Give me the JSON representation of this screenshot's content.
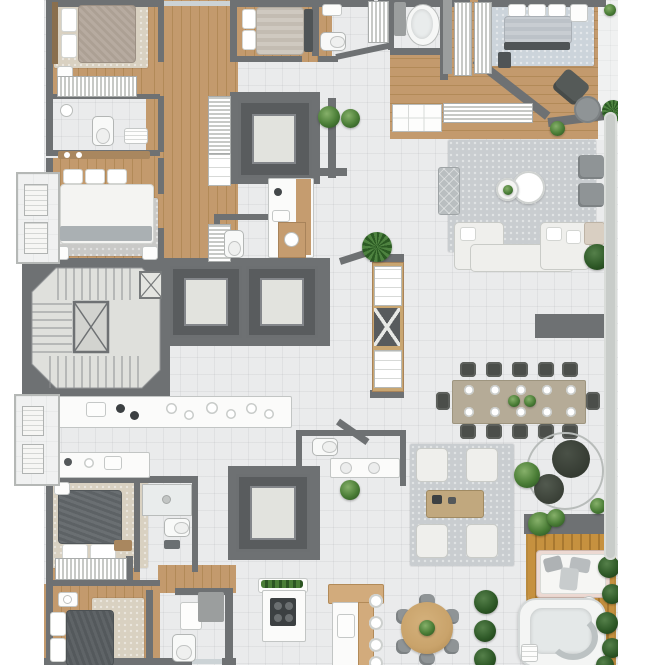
{
  "meta": {
    "title": "Residential apartment floor plan — top-down 3D render",
    "domain_note": "architectural floor plan, no on-screen text",
    "view": "top-down orthographic"
  },
  "palette": {
    "wall": "#6e7173",
    "wallLight": "#9a9da0",
    "tile": "#eaebec",
    "tileLight": "#f0f1f1",
    "wood": "#c39a6d",
    "woodDark": "#b28a58",
    "deck": "#c6913f",
    "deckDark": "#a87830",
    "shaft": "#595c5e",
    "shaftInner": "#e2e3de",
    "rugGray": "#c9cdd0",
    "rugBlue": "#ccd4db",
    "rugBeige": "#d9d1c1",
    "sofaWhite": "#efefec",
    "chairDark": "#4b4e4a",
    "chairGray": "#8f9496",
    "tableWood": "#b5ab97",
    "roundTableWood": "#c9a36b",
    "plantGreen": "#4a7d36",
    "railing": "#c8ccc9",
    "glass": "#ccd3d6",
    "hotTubWhite": "#f4f5f4"
  },
  "rooms": [
    {
      "id": "bedroom-1",
      "area": "top-left",
      "contents": [
        "double bed",
        "rug",
        "wardrobe",
        "nightstand"
      ]
    },
    {
      "id": "bathroom-1",
      "area": "top-left",
      "contents": [
        "toilet",
        "floor lamp",
        "towels"
      ]
    },
    {
      "id": "bedroom-2",
      "area": "left",
      "contents": [
        "double bed",
        "gray rug",
        "two nightstands"
      ]
    },
    {
      "id": "bedroom-3",
      "area": "top-middle",
      "contents": [
        "double bed",
        "bench"
      ]
    },
    {
      "id": "bathroom-2",
      "area": "top-middle",
      "contents": [
        "toilet",
        "sink",
        "closet"
      ]
    },
    {
      "id": "master-bathroom",
      "area": "top-right",
      "contents": [
        "oval bathtub",
        "vanity"
      ]
    },
    {
      "id": "master-suite",
      "area": "top-right",
      "contents": [
        "double bed",
        "walk-in closet",
        "dresser",
        "armchair",
        "ottoman"
      ]
    },
    {
      "id": "living-room",
      "area": "right",
      "contents": [
        "L-sofa set",
        "two round coffee tables",
        "two armchairs",
        "quilted pouf",
        "large rug",
        "TV wall"
      ]
    },
    {
      "id": "dining-room",
      "area": "right-center",
      "contents": [
        "12-seat dining table",
        "place settings",
        "two plants"
      ]
    },
    {
      "id": "stairwell",
      "area": "left-center",
      "contents": [
        "switchback stairs",
        "central void",
        "service shaft"
      ]
    },
    {
      "id": "elevator-bank",
      "area": "center",
      "contents": [
        "four elevator shafts"
      ]
    },
    {
      "id": "kitchen",
      "area": "center-left",
      "contents": [
        "long counter",
        "cooktop",
        "sink",
        "plates"
      ]
    },
    {
      "id": "guest-bathrooms",
      "area": "center",
      "contents": [
        "toilet + wood vanity",
        "toilet + double vanity"
      ]
    },
    {
      "id": "bedroom-4",
      "area": "bottom-left",
      "contents": [
        "double bed",
        "rug",
        "wardrobe",
        "shower bathroom"
      ]
    },
    {
      "id": "bedroom-5",
      "area": "bottom-left",
      "contents": [
        "double bed",
        "rug",
        "bathroom with toilet and sink"
      ]
    },
    {
      "id": "terrace-kitchen",
      "area": "bottom-center",
      "contents": [
        "island with cooktop and planter",
        "L-shaped bar island",
        "four stools",
        "round 6-seat table"
      ]
    },
    {
      "id": "terrace-lounge",
      "area": "bottom-right",
      "contents": [
        "four armchairs",
        "wood coffee table",
        "hanging egg chair",
        "daybed",
        "hot tub",
        "wood deck",
        "planting"
      ]
    },
    {
      "id": "balconies",
      "area": "left-edge",
      "contents": [
        "two service balconies with AC units"
      ]
    }
  ],
  "counts": {
    "bedrooms": 6,
    "elevators": 4,
    "stair_cores": 1,
    "main_dining_seats": 12,
    "round_table_seats": 6,
    "island_stools": 4,
    "lounge_armchairs": 4,
    "living_armchairs": 2,
    "bathtubs": 1,
    "hot_tubs": 1,
    "toilets": 6,
    "balcony_ac_units": 4
  }
}
